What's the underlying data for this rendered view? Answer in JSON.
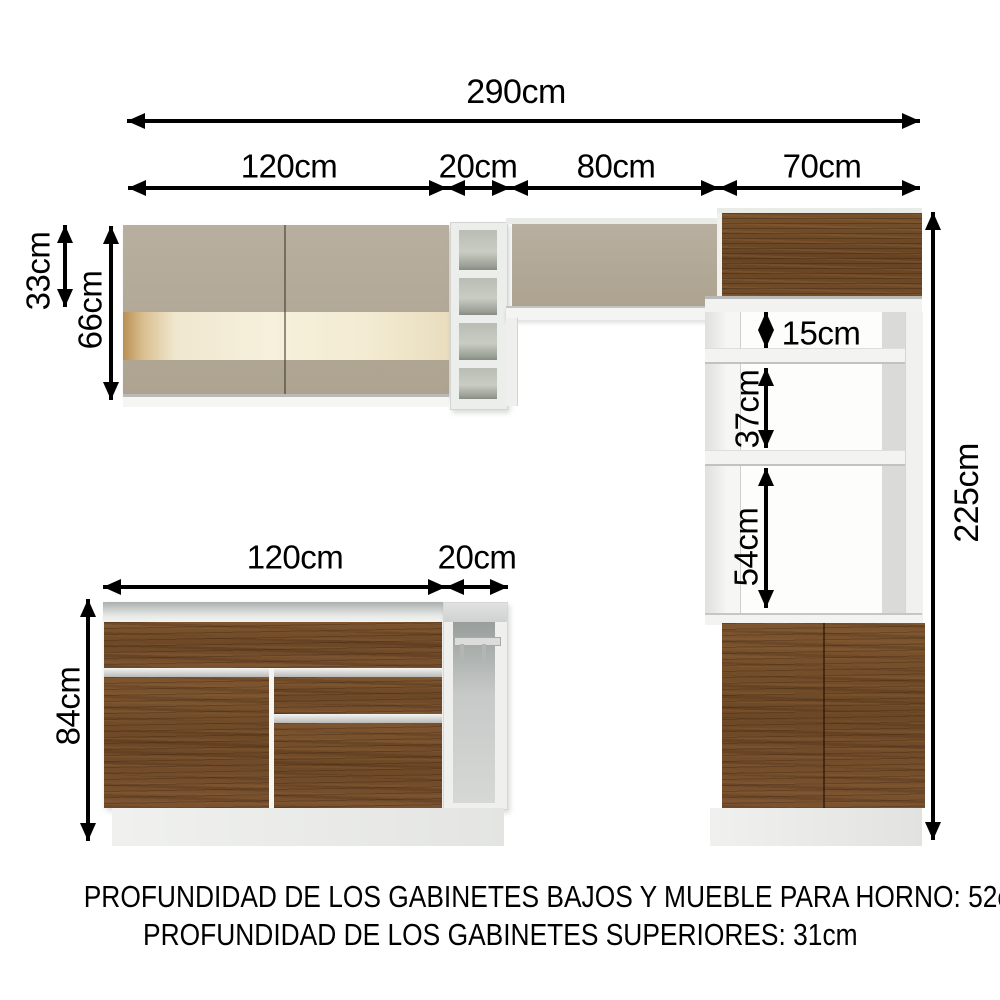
{
  "dims": {
    "total_width": "290cm",
    "top_segments": {
      "s120": "120cm",
      "s20": "20cm",
      "s80": "80cm",
      "s70": "70cm"
    },
    "upper": {
      "h33": "33cm",
      "h66": "66cm"
    },
    "tall": {
      "g15": "15cm",
      "g37": "37cm",
      "g54": "54cm",
      "total_height": "225cm"
    },
    "base": {
      "w120": "120cm",
      "w20": "20cm",
      "h84": "84cm"
    }
  },
  "footer": {
    "line1": "PROFUNDIDAD DE LOS GABINETES BAJOS Y MUEBLE PARA HORNO: 52cm",
    "line2": "PROFUNDIDAD DE LOS GABINETES SUPERIORES: 31cm"
  },
  "colors": {
    "dimension_ink": "#000000",
    "taupe_door": "#b1a796",
    "cream_glass": "#f2ead4",
    "wood_brown": "#74512c",
    "frame_white": "#f2f3f1",
    "interior_gray": "#b9beb5",
    "plinth_gray": "#eaebe9"
  }
}
